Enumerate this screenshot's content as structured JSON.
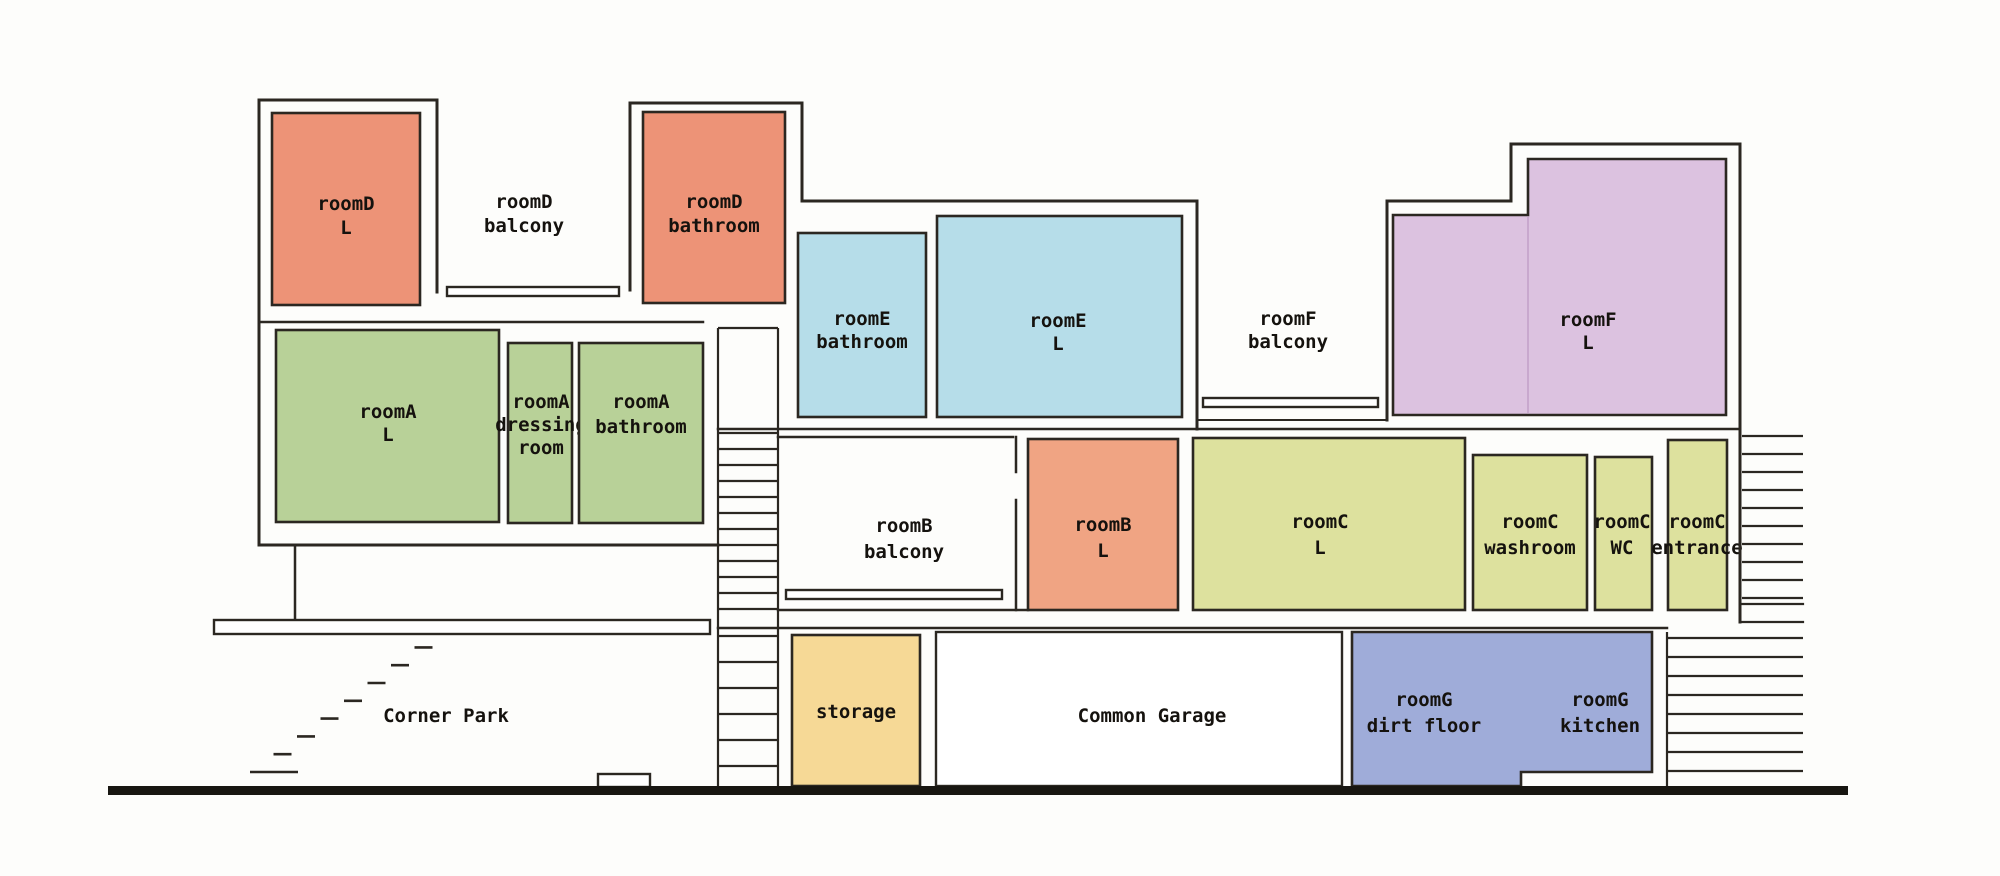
{
  "title": "Apartment building cross-section floor plan",
  "colors": {
    "salmon": "#ED9377",
    "salmon_b": "#F0A483",
    "green": "#B8D198",
    "blue": "#B6DDE9",
    "purple": "#DCC2E0",
    "yellow_green": "#DDE19E",
    "tan": "#F6D996",
    "periwinkle": "#9FACD9",
    "wall": "#2b2721",
    "ground": "#181611"
  },
  "rooms": [
    {
      "name": "roomD-L",
      "label_lines": [
        "roomD",
        "L"
      ],
      "x": 272,
      "y": 113,
      "w": 148,
      "h": 192,
      "fill": "#ED9377",
      "lx": 346,
      "ly": 210,
      "dy": 24
    },
    {
      "name": "roomD-bathroom",
      "label_lines": [
        "roomD",
        "bathroom"
      ],
      "x": 643,
      "y": 112,
      "w": 142,
      "h": 191,
      "fill": "#ED9377",
      "lx": 714,
      "ly": 208,
      "dy": 24
    },
    {
      "name": "roomA-L",
      "label_lines": [
        "roomA",
        "L"
      ],
      "x": 276,
      "y": 330,
      "w": 223,
      "h": 192,
      "fill": "#B8D198",
      "lx": 388,
      "ly": 418,
      "dy": 23
    },
    {
      "name": "roomA-dressing-room",
      "label_lines": [
        "roomA",
        "dressing",
        "room"
      ],
      "x": 508,
      "y": 343,
      "w": 64,
      "h": 180,
      "fill": "#B8D198",
      "lx": 541,
      "ly": 408,
      "dy": 23
    },
    {
      "name": "roomA-bathroom",
      "label_lines": [
        "roomA",
        "bathroom"
      ],
      "x": 579,
      "y": 343,
      "w": 124,
      "h": 180,
      "fill": "#B8D198",
      "lx": 641,
      "ly": 408,
      "dy": 25
    },
    {
      "name": "roomE-bathroom",
      "label_lines": [
        "roomE",
        "bathroom"
      ],
      "x": 798,
      "y": 233,
      "w": 128,
      "h": 184,
      "fill": "#B6DDE9",
      "lx": 862,
      "ly": 325,
      "dy": 23
    },
    {
      "name": "roomE-L",
      "label_lines": [
        "roomE",
        "L"
      ],
      "x": 937,
      "y": 216,
      "w": 245,
      "h": 201,
      "fill": "#B6DDE9",
      "lx": 1058,
      "ly": 327,
      "dy": 23
    },
    {
      "name": "roomF-L",
      "label_lines": [
        "roomF",
        "L"
      ],
      "path": "M1393,215 L1528,215 L1528,159 L1726,159 L1726,415 L1393,415 Z",
      "divider": "M1528,217 L1528,413",
      "fill": "#DCC2E0",
      "lx": 1588,
      "ly": 326,
      "dy": 23
    },
    {
      "name": "roomB-L",
      "label_lines": [
        "roomB",
        "L"
      ],
      "x": 1028,
      "y": 439,
      "w": 150,
      "h": 171,
      "fill": "#F0A483",
      "lx": 1103,
      "ly": 531,
      "dy": 26
    },
    {
      "name": "roomC-L",
      "label_lines": [
        "roomC",
        "L"
      ],
      "x": 1193,
      "y": 438,
      "w": 272,
      "h": 172,
      "fill": "#DDE19E",
      "lx": 1320,
      "ly": 528,
      "dy": 26
    },
    {
      "name": "roomC-washroom",
      "label_lines": [
        "roomC",
        "washroom"
      ],
      "x": 1473,
      "y": 455,
      "w": 114,
      "h": 155,
      "fill": "#DDE19E",
      "lx": 1530,
      "ly": 528,
      "dy": 26
    },
    {
      "name": "roomC-WC",
      "label_lines": [
        "roomC",
        "WC"
      ],
      "x": 1595,
      "y": 457,
      "w": 57,
      "h": 153,
      "fill": "#DDE19E",
      "lx": 1622,
      "ly": 528,
      "dy": 26
    },
    {
      "name": "roomC-entrance",
      "label_lines": [
        "roomC",
        "entrance"
      ],
      "x": 1668,
      "y": 440,
      "w": 59,
      "h": 170,
      "fill": "#DDE19E",
      "lx": 1697,
      "ly": 528,
      "dy": 26
    },
    {
      "name": "storage",
      "label_lines": [
        "storage"
      ],
      "x": 792,
      "y": 635,
      "w": 128,
      "h": 151,
      "fill": "#F6D996",
      "lx": 856,
      "ly": 718,
      "dy": 24
    },
    {
      "name": "roomG",
      "label_lines": [],
      "path": "M1352,632 L1652,632 L1652,772 L1521,772 L1521,786 L1352,786 Z",
      "fill": "#9FACD9",
      "lx": 1500,
      "ly": 705,
      "dy": 24
    }
  ],
  "labels": [
    {
      "name": "roomD-balcony-label",
      "lines": [
        "roomD",
        "balcony"
      ],
      "x": 524,
      "y": 208,
      "dy": 24
    },
    {
      "name": "roomF-balcony-label",
      "lines": [
        "roomF",
        "balcony"
      ],
      "x": 1288,
      "y": 325,
      "dy": 23
    },
    {
      "name": "roomB-balcony-label",
      "lines": [
        "roomB",
        "balcony"
      ],
      "x": 904,
      "y": 532,
      "dy": 26
    },
    {
      "name": "roomG-dirt-floor-label",
      "lines": [
        "roomG",
        "dirt floor"
      ],
      "x": 1424,
      "y": 706,
      "dy": 26
    },
    {
      "name": "roomG-kitchen-label",
      "lines": [
        "roomG",
        "kitchen"
      ],
      "x": 1600,
      "y": 706,
      "dy": 26
    },
    {
      "name": "corner-park-label",
      "lines": [
        "Corner Park"
      ],
      "x": 446,
      "y": 722,
      "dy": 24
    },
    {
      "name": "common-garage-label",
      "lines": [
        "Common Garage"
      ],
      "x": 1152,
      "y": 722,
      "dy": 24
    }
  ],
  "walls": [
    {
      "name": "left-building-outer-wall",
      "d": "M718,545 L259,545 L259,100 L437,100 L437,292",
      "w": 3
    },
    {
      "name": "roomA-top-wall",
      "d": "M259,322 L703,322",
      "w": 2.5
    },
    {
      "name": "roomD-bathroom-block-wall",
      "d": "M630,290 L630,103 L802,103 L802,201 L1197,201 L1197,429",
      "w": 3
    },
    {
      "name": "second-floor-slab-line",
      "d": "M718,429 L1740,429",
      "w": 2.5
    },
    {
      "name": "roomF-balcony-slab-line",
      "d": "M1197,420 L1387,420",
      "w": 2
    },
    {
      "name": "roomF-outer-wall",
      "d": "M1387,420 L1387,201 L1511,201 L1511,144 L1740,144 L1740,622",
      "w": 3
    },
    {
      "name": "roomB-balcony-top-wall",
      "d": "M778,437 L1013,437",
      "w": 2.5
    },
    {
      "name": "roomB-wall-stub",
      "d": "M1016,437 L1016,472 M1016,500 L1016,610",
      "w": 2.5
    },
    {
      "name": "roomB-balcony-floor-line",
      "d": "M778,610 L1028,610",
      "w": 2.5
    },
    {
      "name": "first-floor-slab-line",
      "d": "M718,628 L1667,628",
      "w": 2.5
    },
    {
      "name": "right-stair-landing-lines",
      "d": "M1742,604 L1803,604 M1742,622 L1803,622",
      "w": 2.2
    },
    {
      "name": "canopy-post",
      "d": "M295,545 L295,620",
      "w": 2.5
    }
  ],
  "slabs": [
    {
      "name": "roomD-balcony-railing",
      "x": 447,
      "y": 287,
      "w": 172,
      "h": 9
    },
    {
      "name": "roomF-balcony-railing",
      "x": 1203,
      "y": 398,
      "w": 175,
      "h": 9
    },
    {
      "name": "roomB-balcony-railing",
      "x": 786,
      "y": 590,
      "w": 216,
      "h": 9
    },
    {
      "name": "corner-park-canopy",
      "x": 214,
      "y": 620,
      "w": 496,
      "h": 14
    },
    {
      "name": "entrance-step",
      "x": 598,
      "y": 774,
      "w": 52,
      "h": 13
    },
    {
      "name": "garage-box",
      "x": 936,
      "y": 632,
      "w": 406,
      "h": 154
    }
  ],
  "stairs": [
    {
      "name": "central-stairwell",
      "lines": [
        "M718,328 L718,786",
        "M778,328 L778,786",
        "M718,328 L778,328"
      ],
      "rungs": {
        "x1": 718,
        "x2": 778,
        "y0": 433,
        "step": 16,
        "count": 12
      }
    },
    {
      "name": "central-stairwell-lower-flight",
      "lines": [],
      "rungs": {
        "x1": 718,
        "x2": 778,
        "y0": 636,
        "step": 26,
        "count": 6
      }
    },
    {
      "name": "right-upper-stair",
      "lines": [],
      "rungs": {
        "x1": 1742,
        "x2": 1803,
        "y0": 436,
        "step": 18,
        "count": 10
      }
    },
    {
      "name": "right-lower-stair",
      "lines": [
        "M1667,632 L1667,786"
      ],
      "rungs": {
        "x1": 1667,
        "x2": 1803,
        "y0": 638,
        "step": 19,
        "count": 8
      }
    }
  ],
  "corner_steps": {
    "count": 8,
    "x0": 250,
    "dx": 23.5,
    "y0": 772,
    "dy": -17.8,
    "len": 18,
    "first_len": 48
  },
  "ground": {
    "x": 108,
    "y": 786,
    "w": 1740,
    "h": 9
  }
}
